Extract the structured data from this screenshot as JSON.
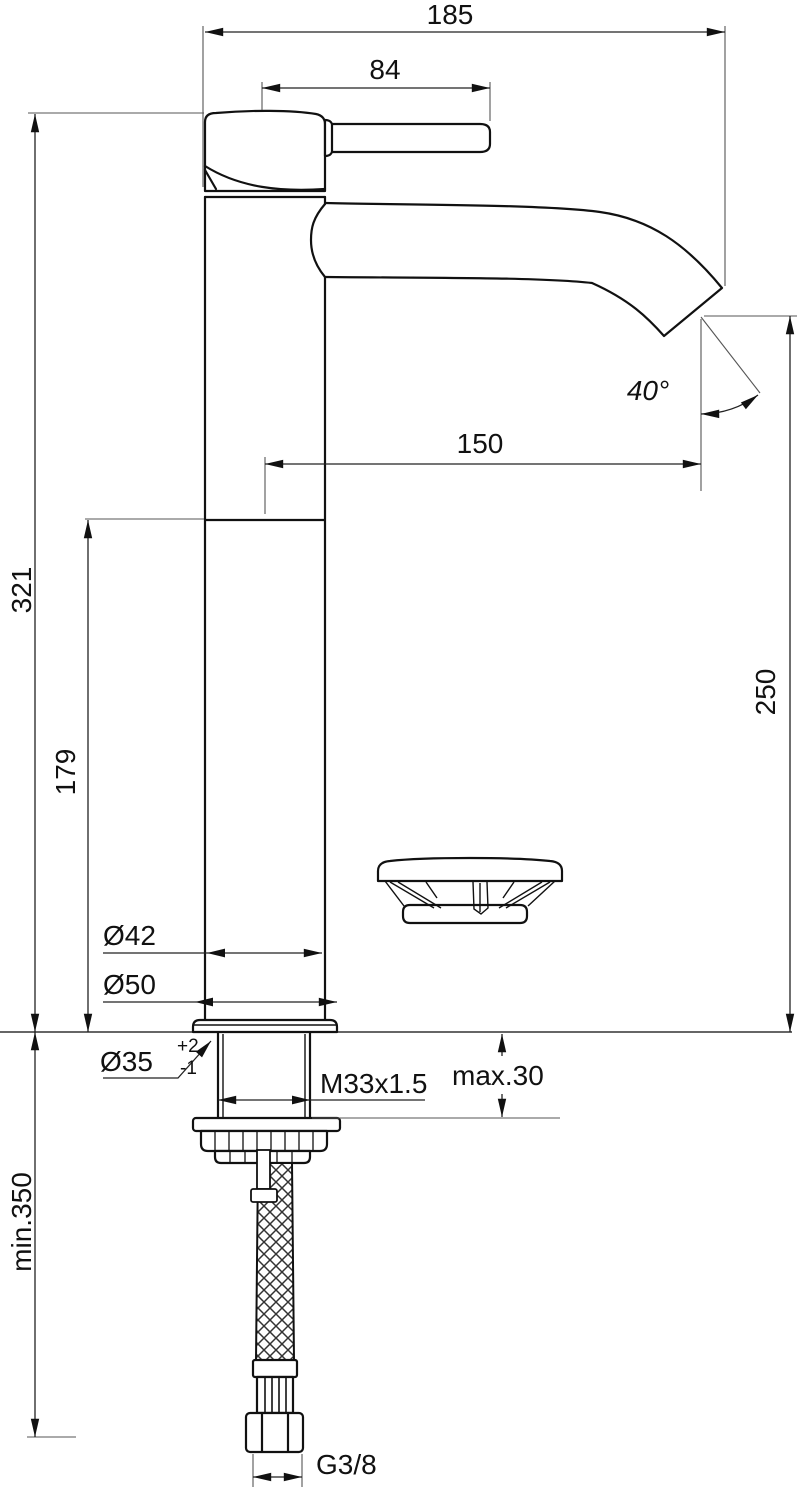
{
  "labels": {
    "overall_width": "185",
    "handle_length": "84",
    "spout_reach": "150",
    "spout_angle": "40°",
    "total_height": "321",
    "lower_body_height": "179",
    "outlet_height": "250",
    "body_diameter": "Ø42",
    "base_diameter": "Ø50",
    "hole_diameter": "Ø35",
    "hole_tol_plus": "+2",
    "hole_tol_minus": "-1",
    "thread_spec": "M33x1.5",
    "deck_thickness_max": "max.30",
    "hose_clearance_min": "min.350",
    "hose_connection": "G3/8"
  },
  "colors": {
    "line": "#111111",
    "thin_line": "#555555",
    "background": "#ffffff"
  }
}
